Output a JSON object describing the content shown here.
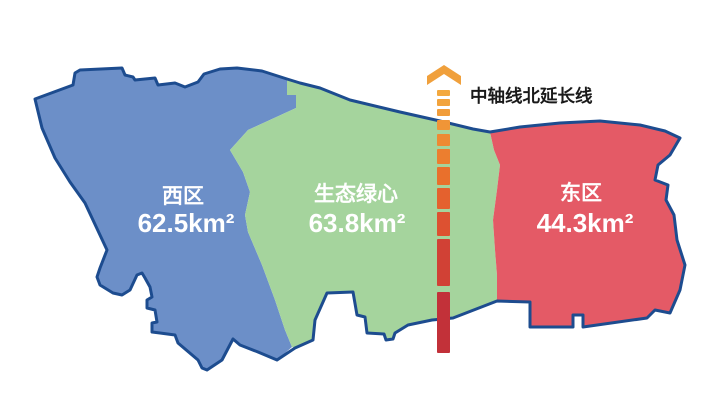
{
  "map": {
    "outline_color": "#1d4c8f",
    "regions": [
      {
        "id": "west",
        "name": "西区",
        "area": "62.5km²",
        "fill": "#6c8fc8",
        "label_color": "#ffffff"
      },
      {
        "id": "green-heart",
        "name": "生态绿心",
        "area": "63.8km²",
        "fill": "#a5d49d",
        "label_color": "#ffffff"
      },
      {
        "id": "east",
        "name": "东区",
        "area": "44.3km²",
        "fill": "#e45a66",
        "label_color": "#ffffff"
      }
    ]
  },
  "axis": {
    "label": "中轴线北延长线",
    "label_color": "#1a1a1a",
    "arrow_color": "#f0a03c",
    "line_x": 437,
    "line_width": 13,
    "segments": [
      {
        "y": 90,
        "h": 6,
        "color": "#f3a83e"
      },
      {
        "y": 99,
        "h": 7,
        "color": "#f2a33c"
      },
      {
        "y": 109,
        "h": 7,
        "color": "#f19d3a"
      },
      {
        "y": 120,
        "h": 10,
        "color": "#f09537"
      },
      {
        "y": 134,
        "h": 12,
        "color": "#ee8a33"
      },
      {
        "y": 149,
        "h": 15,
        "color": "#ec7e2f"
      },
      {
        "y": 167,
        "h": 18,
        "color": "#e9702c"
      },
      {
        "y": 188,
        "h": 21,
        "color": "#e4612e"
      },
      {
        "y": 212,
        "h": 24,
        "color": "#dd5131"
      },
      {
        "y": 239,
        "h": 47,
        "color": "#d14135"
      },
      {
        "y": 292,
        "h": 61,
        "color": "#c23139"
      }
    ]
  }
}
